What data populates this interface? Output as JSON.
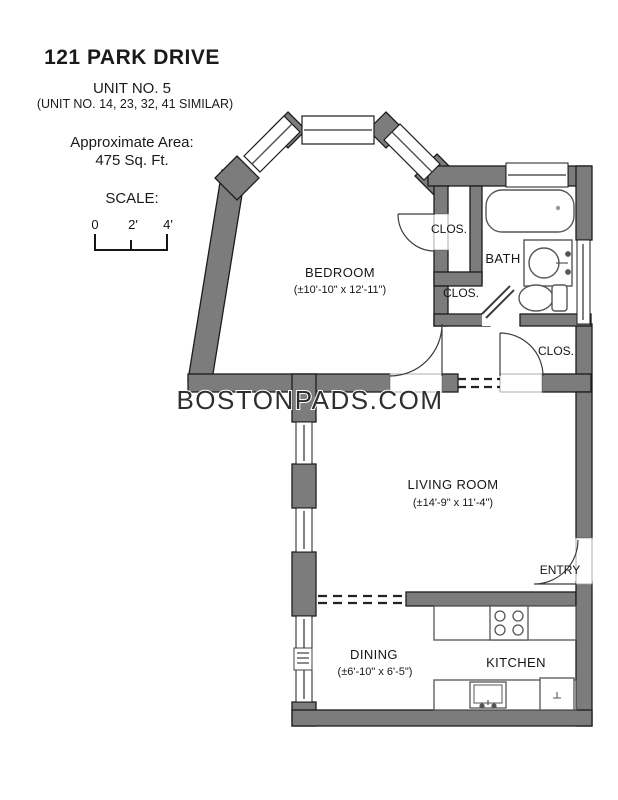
{
  "header": {
    "title": "121 PARK DRIVE",
    "unit": "UNIT NO. 5",
    "similar_units": "(UNIT NO. 14, 23, 32, 41 SIMILAR)",
    "area_label": "Approximate Area:",
    "area_value": "475 Sq. Ft.",
    "scale_label": "SCALE:",
    "scale_ticks": [
      "0",
      "2'",
      "4'"
    ]
  },
  "watermark": "BOSTONPADS.COM",
  "rooms": {
    "bedroom": {
      "name": "BEDROOM",
      "dimensions": "(±10'-10\" x 12'-11\")"
    },
    "bath": {
      "name": "BATH"
    },
    "closet_upper": {
      "name": "CLOS."
    },
    "closet_middle": {
      "name": "CLOS."
    },
    "closet_lower": {
      "name": "CLOS."
    },
    "living_room": {
      "name": "LIVING ROOM",
      "dimensions": "(±14'-9\" x 11'-4\")"
    },
    "entry": {
      "name": "ENTRY"
    },
    "dining": {
      "name": "DINING",
      "dimensions": "(±6'-10\" x 6'-5\")"
    },
    "kitchen": {
      "name": "KITCHEN"
    }
  },
  "icons": {
    "bathtub": "bathtub-icon",
    "bath_sink": "sink-icon",
    "toilet": "toilet-icon",
    "stove": "stove-4-burner-icon",
    "kitchen_sink": "kitchen-sink-icon",
    "refrigerator": "refrigerator-icon",
    "radiator": "radiator-icon"
  },
  "colors": {
    "wall": "#7c7c7c",
    "wall_edge": "#1c1c1c",
    "background": "#ffffff",
    "watermark": "#2e2e2e"
  }
}
